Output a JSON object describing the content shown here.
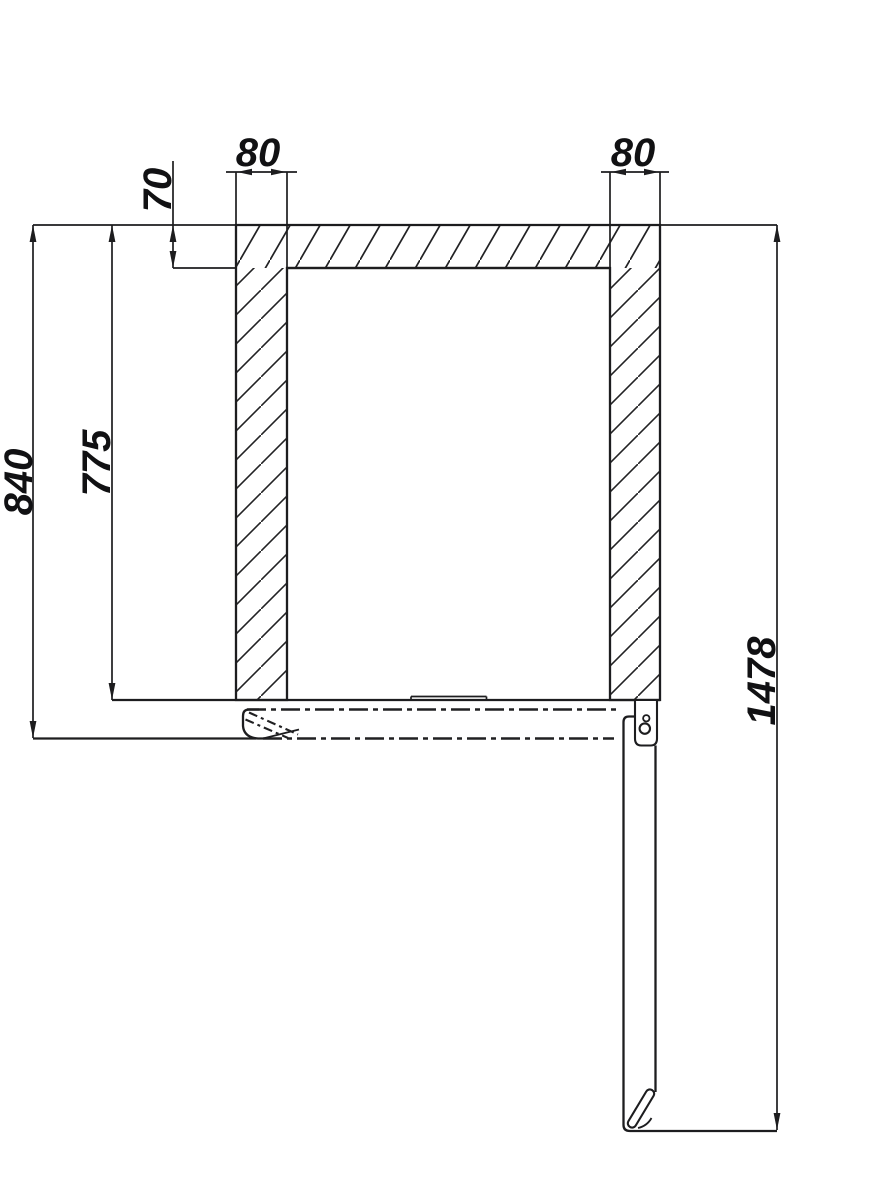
{
  "drawing": {
    "description": "technical-section-drawing",
    "background_color": "#ffffff",
    "line_color": "#1d1d1f",
    "labels": {
      "col_left_width": "80",
      "col_right_width": "80",
      "top_bar_thickness": "70",
      "clear_height": "775",
      "frame_height": "840",
      "overall_height": "1478"
    }
  }
}
